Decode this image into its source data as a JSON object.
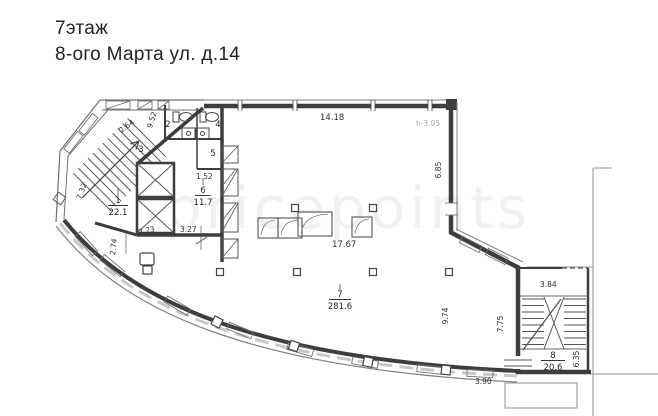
{
  "title": {
    "line1": "7этаж",
    "line2": "8-ого Марта ул. д.14"
  },
  "watermark": "pricepoints",
  "plan": {
    "note_height": "h-3.05",
    "rooms": {
      "r1": {
        "number": "1",
        "area": "22.1"
      },
      "r2": {
        "number": "2"
      },
      "r3": {
        "number": "3"
      },
      "r4": {
        "number": "4"
      },
      "r5": {
        "number": "5"
      },
      "r6": {
        "number": "6",
        "area": "11.7"
      },
      "r7": {
        "number": "7",
        "area": "281.6"
      },
      "r8": {
        "number": "8",
        "area": "20.6"
      }
    },
    "dims": {
      "chamfer": "2.64",
      "chamfer2": "9.52",
      "top": "14.18",
      "right": "6.85",
      "room6_w": "1.52",
      "room6_b": "3.27",
      "core1": "2.73",
      "core2": "2.74",
      "room1": "7.32",
      "hall": "17.67",
      "hall_r": "9.74",
      "hall_rw": "7.75",
      "stair_top": "3.84",
      "stair_r": "6.35",
      "bottom": "3.90"
    },
    "colors": {
      "ink": "#3d3d3d",
      "thin": "#707070",
      "faint": "#a9a9a9"
    }
  }
}
